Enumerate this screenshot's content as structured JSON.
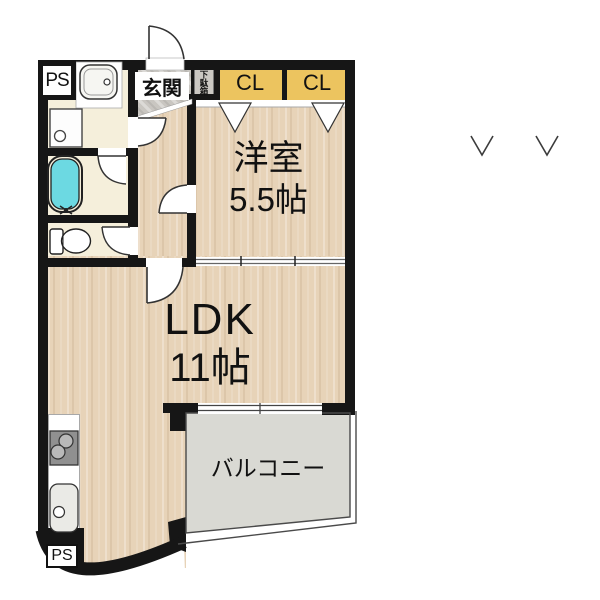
{
  "plan": {
    "type": "apartment-floor-plan",
    "rooms": {
      "western_room": {
        "label": "洋室",
        "size": "5.5帖"
      },
      "ldk": {
        "label": "LDK",
        "size": "11帖"
      },
      "balcony": {
        "label": "バルコニー"
      },
      "entrance": {
        "label": "玄関"
      },
      "shoe_cabinet": {
        "label": "下駄箱"
      },
      "closet_left": {
        "label": "CL"
      },
      "closet_right": {
        "label": "CL"
      },
      "pipe_space_top": {
        "label": "PS"
      },
      "pipe_space_bottom": {
        "label": "PS"
      }
    },
    "fixtures": [
      "washbasin",
      "washing-machine-pan",
      "bathtub",
      "toilet",
      "gas-stove",
      "kitchen-sink",
      "entrance-door",
      "hinged-doors",
      "sliding-door",
      "sliding-window",
      "folding-closet-doors"
    ],
    "marks": [
      "check-v-mark",
      "check-v-mark"
    ],
    "colors": {
      "wall": "#161616",
      "wood_floor": "#e7d3b8",
      "utility_cream": "#f5efdb",
      "entrance_tile": "#c9c6c1",
      "closet_yellow": "#ecc45f",
      "bathtub_cyan": "#6cd9e2",
      "balcony_gray": "#d9d9d3"
    }
  }
}
